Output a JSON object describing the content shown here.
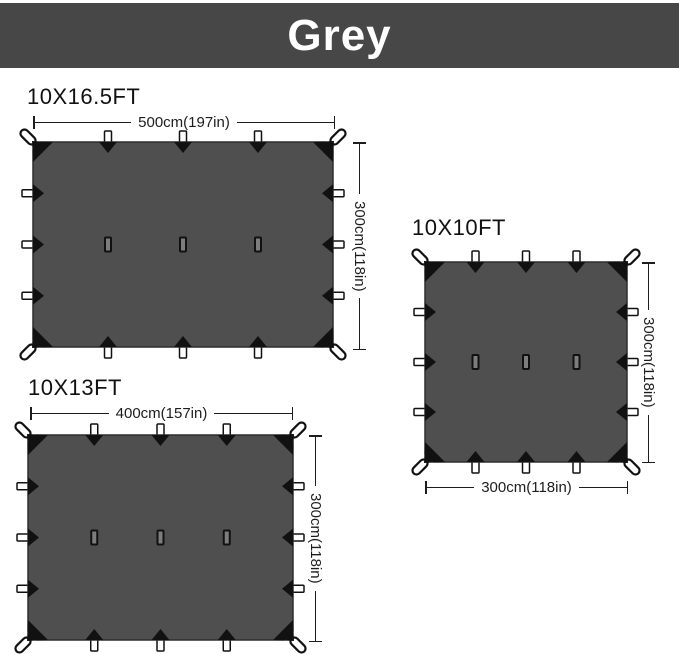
{
  "banner": {
    "label": "Grey"
  },
  "colors": {
    "banner_bg": "#474747",
    "banner_text": "#ffffff",
    "tarp_fill": "#4f4f4f",
    "tarp_border": "#2e2e2e",
    "detail_black": "#111111",
    "tab_fill": "#ffffff",
    "hang_loop_fill": "#7d7d7d",
    "dimension_line": "#1d1d1d",
    "title_text": "#111111"
  },
  "tarps": [
    {
      "title": "10X16.5FT",
      "width_label": "500cm(197in)",
      "height_label": "300cm(118in)"
    },
    {
      "title": "10X10FT",
      "width_label": "300cm(118in)",
      "height_label": "300cm(118in)"
    },
    {
      "title": "10X13FT",
      "width_label": "400cm(157in)",
      "height_label": "300cm(118in)"
    }
  ]
}
